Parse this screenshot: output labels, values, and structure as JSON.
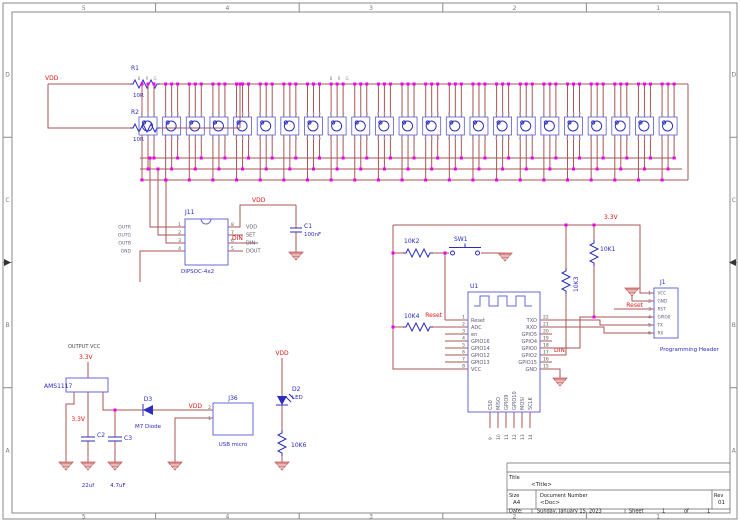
{
  "colors": {
    "wire": "#a85555",
    "component_blue": "#2c2cbf",
    "net_red": "#e01818",
    "junction_magenta": "#ee00ee",
    "ground": "#bf5f5f"
  },
  "frame": {
    "column_labels": [
      "5",
      "4",
      "3",
      "2",
      "1"
    ],
    "row_labels": [
      "D",
      "C",
      "B",
      "A"
    ]
  },
  "nets": {
    "vdd": "VDD",
    "v33": "3.3V",
    "reset": "Reset",
    "din": "DIN"
  },
  "top_left": {
    "r1_ref": "R1",
    "r1_value": "10R",
    "r2_ref": "R2",
    "r2_value": "10R"
  },
  "led_row": {
    "count": 23,
    "bus_labels": [
      "B",
      "R",
      "G"
    ]
  },
  "socket": {
    "ref": "J11",
    "value": "DIPSOC-4x2",
    "pin_numbers_left": [
      "1",
      "2",
      "3",
      "4"
    ],
    "pin_numbers_right": [
      "8",
      "7",
      "6",
      "5"
    ],
    "net_labels_left": [
      "OUTR",
      "OUTG",
      "OUTB",
      "GND"
    ],
    "pin_labels_right": [
      "VDD",
      "SET",
      "DIN",
      "DOUT"
    ]
  },
  "c1": {
    "ref": "C1",
    "value": "100nF"
  },
  "mcu": {
    "ref": "U1",
    "left_pins": [
      [
        "1",
        "Reset"
      ],
      [
        "2",
        "ADC"
      ],
      [
        "3",
        "en"
      ],
      [
        "4",
        "GPIO16"
      ],
      [
        "5",
        "GPIO14"
      ],
      [
        "6",
        "GPIO12"
      ],
      [
        "7",
        "GPIO13"
      ],
      [
        "8",
        "VCC"
      ]
    ],
    "right_pins": [
      [
        "22",
        "TXD"
      ],
      [
        "21",
        "RXD"
      ],
      [
        "20",
        "GPIO5"
      ],
      [
        "19",
        "GPIO4"
      ],
      [
        "18",
        "GPIO0"
      ],
      [
        "17",
        "GPIO2"
      ],
      [
        "16",
        "GPIO15"
      ],
      [
        "15",
        "GND"
      ]
    ],
    "bottom_pins": [
      [
        "9",
        "CS0"
      ],
      [
        "10",
        "MISO"
      ],
      [
        "11",
        "GPIO9"
      ],
      [
        "12",
        "GPIO10"
      ],
      [
        "13",
        "MOSI"
      ],
      [
        "14",
        "SCLK"
      ]
    ]
  },
  "pull_resistors": {
    "r10k1": "10K1",
    "r10k2": "10K2",
    "r10k3": "10K3",
    "r10k4": "10K4"
  },
  "switch": {
    "ref": "SW1"
  },
  "prog_header": {
    "ref": "J1",
    "caption": "Programming Header",
    "pin_numbers": [
      "1",
      "2",
      "3",
      "4",
      "5",
      "6"
    ],
    "pin_labels": [
      "VCC",
      "GND",
      "RST",
      "GPIO0",
      "TX",
      "RX"
    ]
  },
  "power": {
    "output_vcc": "OUTPUT VCC",
    "regulator": "AMS1117",
    "c2_ref": "C2",
    "c2_value": "22uf",
    "c3_ref": "C3",
    "c3_value": "4.7uF",
    "d3_ref": "D3",
    "d3_value": "M7 Diode",
    "usb_ref": "J36",
    "usb_value": "USB micro",
    "usb_pin2": "2",
    "usb_pin1": "1",
    "led_ref": "D2",
    "led_value": "LED",
    "r_led": "10K6"
  },
  "title_block": {
    "title_label": "Title",
    "title": "<Title>",
    "size_label": "Size",
    "size": "A4",
    "doc_label": "Document Number",
    "doc": "<Doc>",
    "rev_label": "Rev",
    "rev": "01",
    "date_label": "Date:",
    "date": "Sunday, January 15, 2023",
    "sheet_label": "Sheet",
    "sheet_number": "1",
    "of_label": "of",
    "sheet_total": "1"
  }
}
